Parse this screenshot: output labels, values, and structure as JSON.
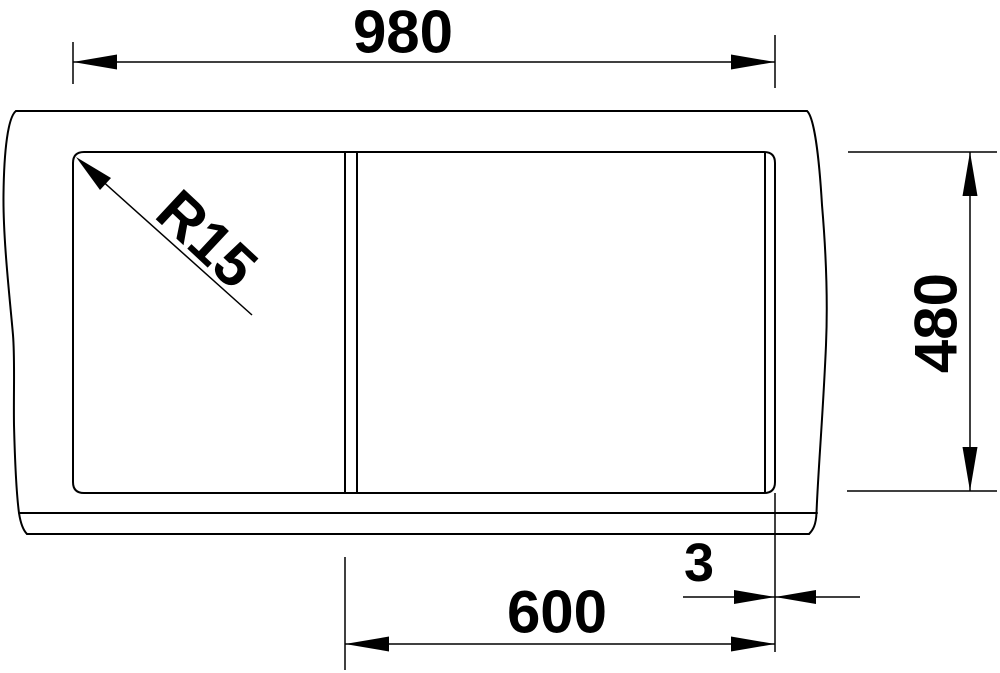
{
  "dimensions": {
    "overall_width": "980",
    "overall_depth": "480",
    "bowl_section_width": "600",
    "rim_offset": "3",
    "corner_radius": "R15"
  },
  "colors": {
    "line": "#000000",
    "background": "#ffffff"
  }
}
